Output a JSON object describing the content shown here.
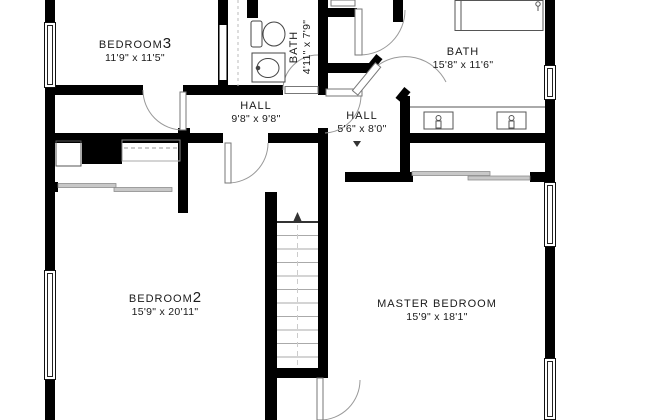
{
  "plan": {
    "title": "Upper floor plan",
    "rooms": {
      "bedroom3": {
        "label": "BEDROOM",
        "number": "3",
        "dims": "11'9\" x 11'5\""
      },
      "bath_small": {
        "label": "BATH",
        "dims": "4'11\" x 7'9\""
      },
      "bath_master": {
        "label": "BATH",
        "dims": "15'8\" x 11'6\""
      },
      "hall_main": {
        "label": "HALL",
        "dims": "9'8\" x 9'8\""
      },
      "hall_inner": {
        "label": "HALL",
        "dims": "5'6\" x 8'0\""
      },
      "bedroom2": {
        "label": "BEDROOM",
        "number": "2",
        "dims": "15'9\" x 20'11\""
      },
      "master_bedroom": {
        "label": "MASTER BEDROOM",
        "dims": "15'9\" x 18'1\""
      }
    },
    "fixtures": [
      "toilet",
      "vanity-sink",
      "double-vanity",
      "shower",
      "stairs-up",
      "closet-rod",
      "sliding-doors"
    ],
    "colors": {
      "wall": "#000000",
      "door_line": "#999999",
      "fixture_line": "#444444",
      "text": "#1a1a1a",
      "background": "#ffffff"
    }
  }
}
